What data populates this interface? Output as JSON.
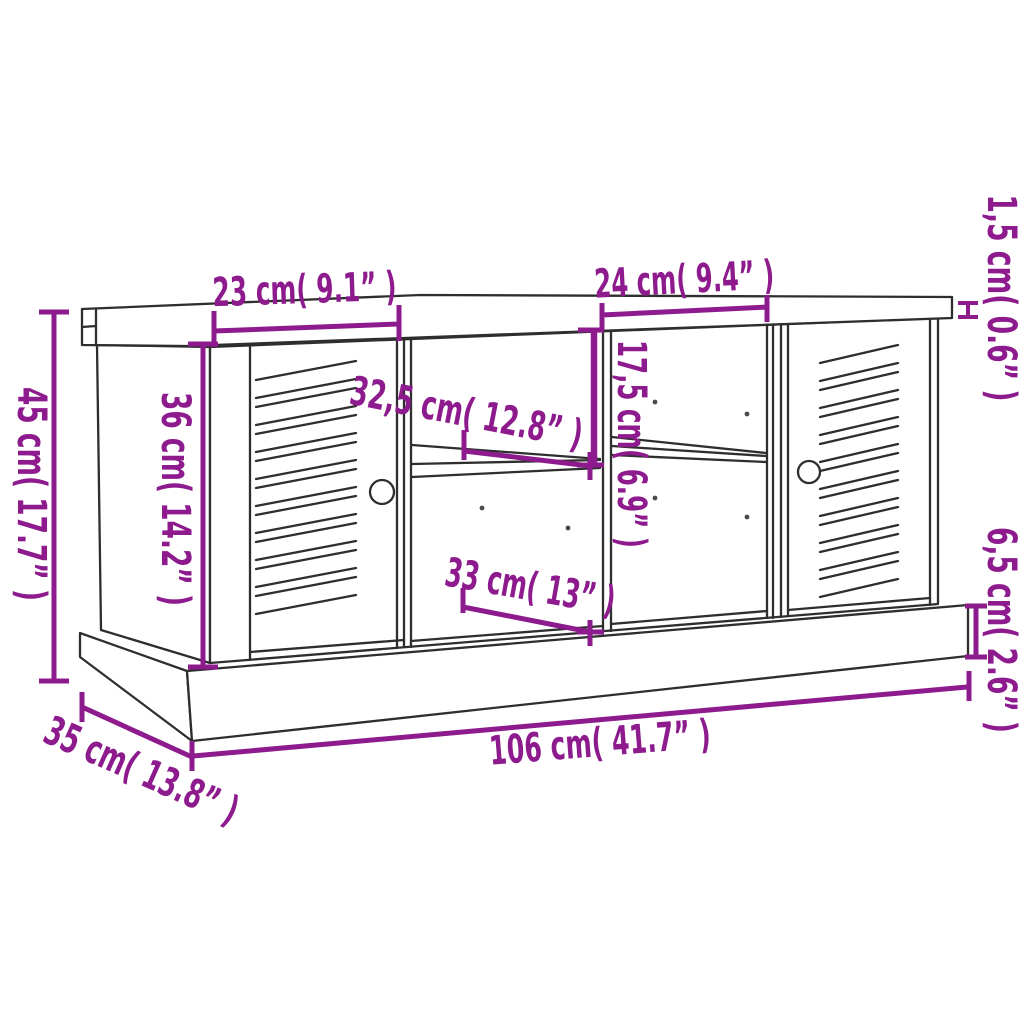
{
  "figure": {
    "kind": "product-dimension-diagram",
    "subject": "storage bench with two louvered doors, centre open shelves and plinth base",
    "view": "three-quarter front perspective line drawing",
    "background_color": "#ffffff",
    "outline_color": "#2e2e2e",
    "dimension_color": "#8e1b8e"
  },
  "dims": [
    {
      "id": "left-door-width",
      "label": "23 cm( 9.1” )",
      "cm": "23",
      "inches": "9.1"
    },
    {
      "id": "right-bay-width",
      "label": "24 cm( 9.4” )",
      "cm": "24",
      "inches": "9.4"
    },
    {
      "id": "top-thickness",
      "label": "1,5 cm( 0.6” )",
      "cm": "1,5",
      "inches": "0.6"
    },
    {
      "id": "overall-height",
      "label": "45 cm( 17.7” )",
      "cm": "45",
      "inches": "17.7"
    },
    {
      "id": "door-height",
      "label": "36 cm( 14.2” )",
      "cm": "36",
      "inches": "14.2"
    },
    {
      "id": "shelf-depth",
      "label": "32,5 cm( 12.8” )",
      "cm": "32,5",
      "inches": "12.8"
    },
    {
      "id": "upper-compartment-height",
      "label": "17,5 cm( 6.9” )",
      "cm": "17,5",
      "inches": "6.9"
    },
    {
      "id": "lower-shelf-width",
      "label": "33 cm( 13” )",
      "cm": "33",
      "inches": "13"
    },
    {
      "id": "plinth-height",
      "label": "6,5 cm( 2.6” )",
      "cm": "6,5",
      "inches": "2.6"
    },
    {
      "id": "overall-width",
      "label": "106 cm( 41.7” )",
      "cm": "106",
      "inches": "41.7"
    },
    {
      "id": "overall-depth",
      "label": "35 cm( 13.8” )",
      "cm": "35",
      "inches": "13.8"
    }
  ]
}
